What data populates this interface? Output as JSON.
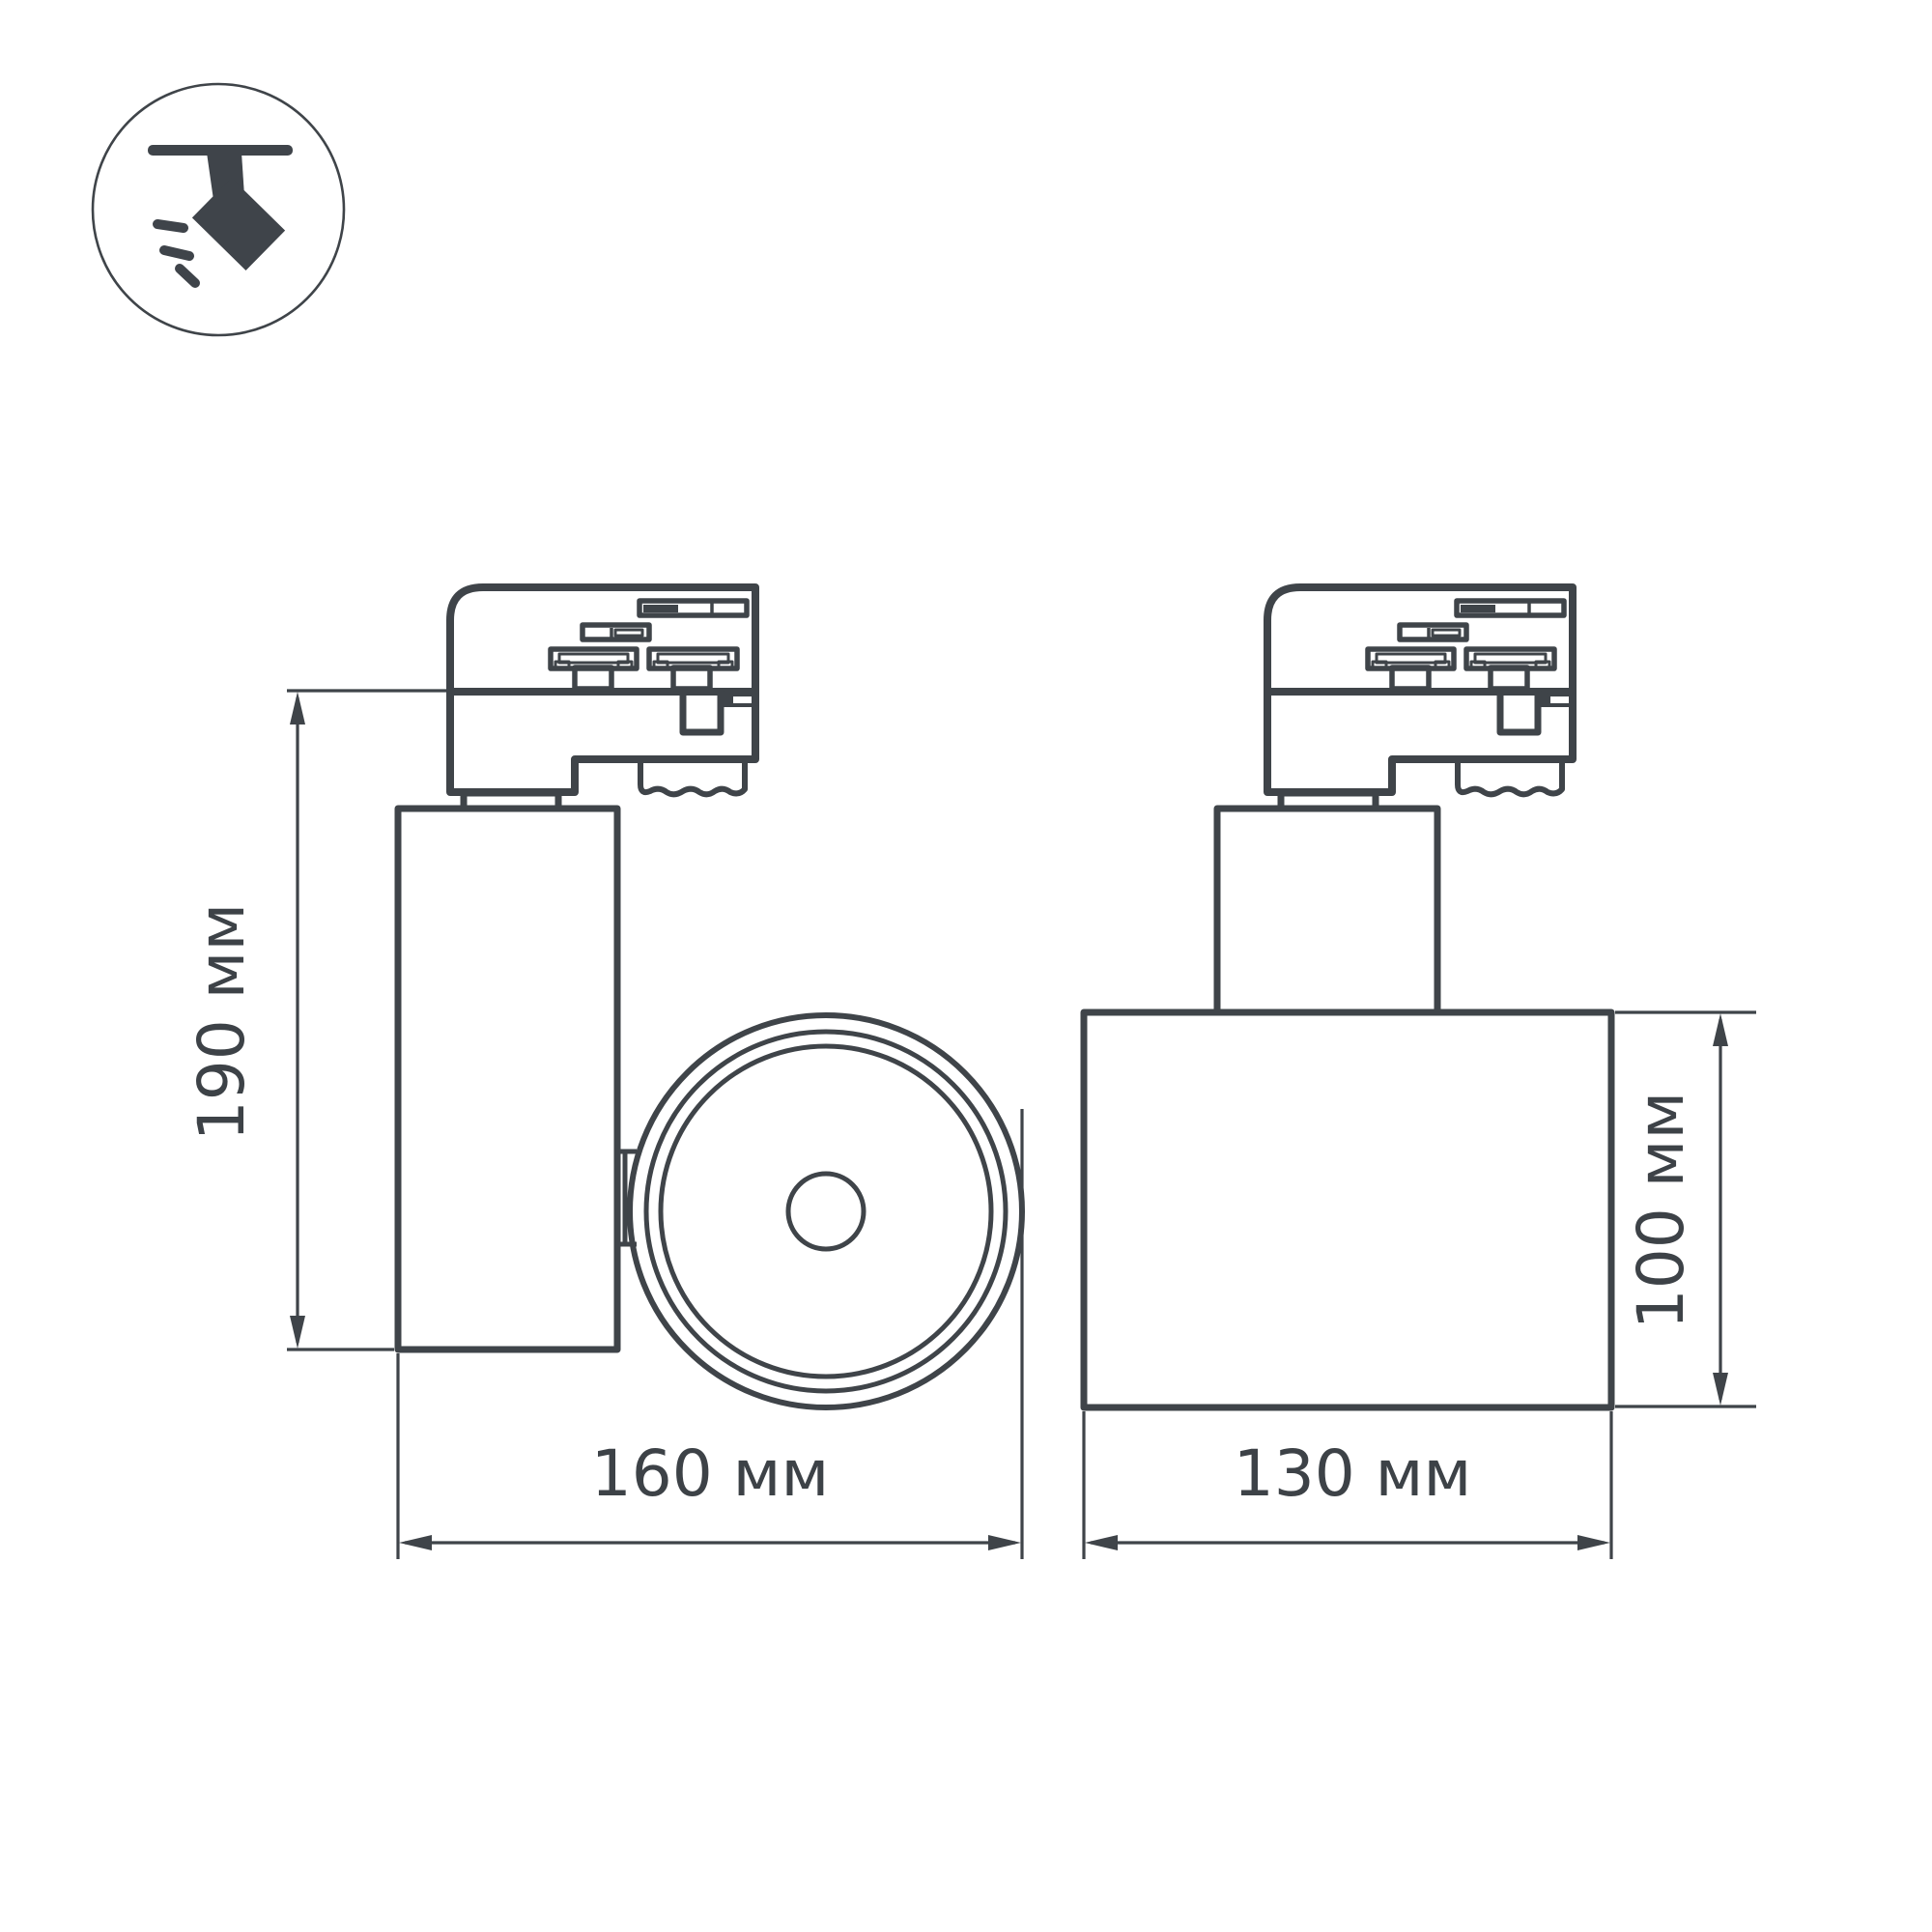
{
  "colors": {
    "bg": "#ffffff",
    "line": "#3f4449",
    "text": "#3d4247",
    "icon": "#3f444a"
  },
  "icon": {
    "name": "track-spotlight-icon"
  },
  "dimensions": {
    "height_side": {
      "label": "190 мм"
    },
    "width_side": {
      "label": "160 мм"
    },
    "width_front": {
      "label": "130 мм"
    },
    "height_front": {
      "label": "100 мм"
    }
  }
}
